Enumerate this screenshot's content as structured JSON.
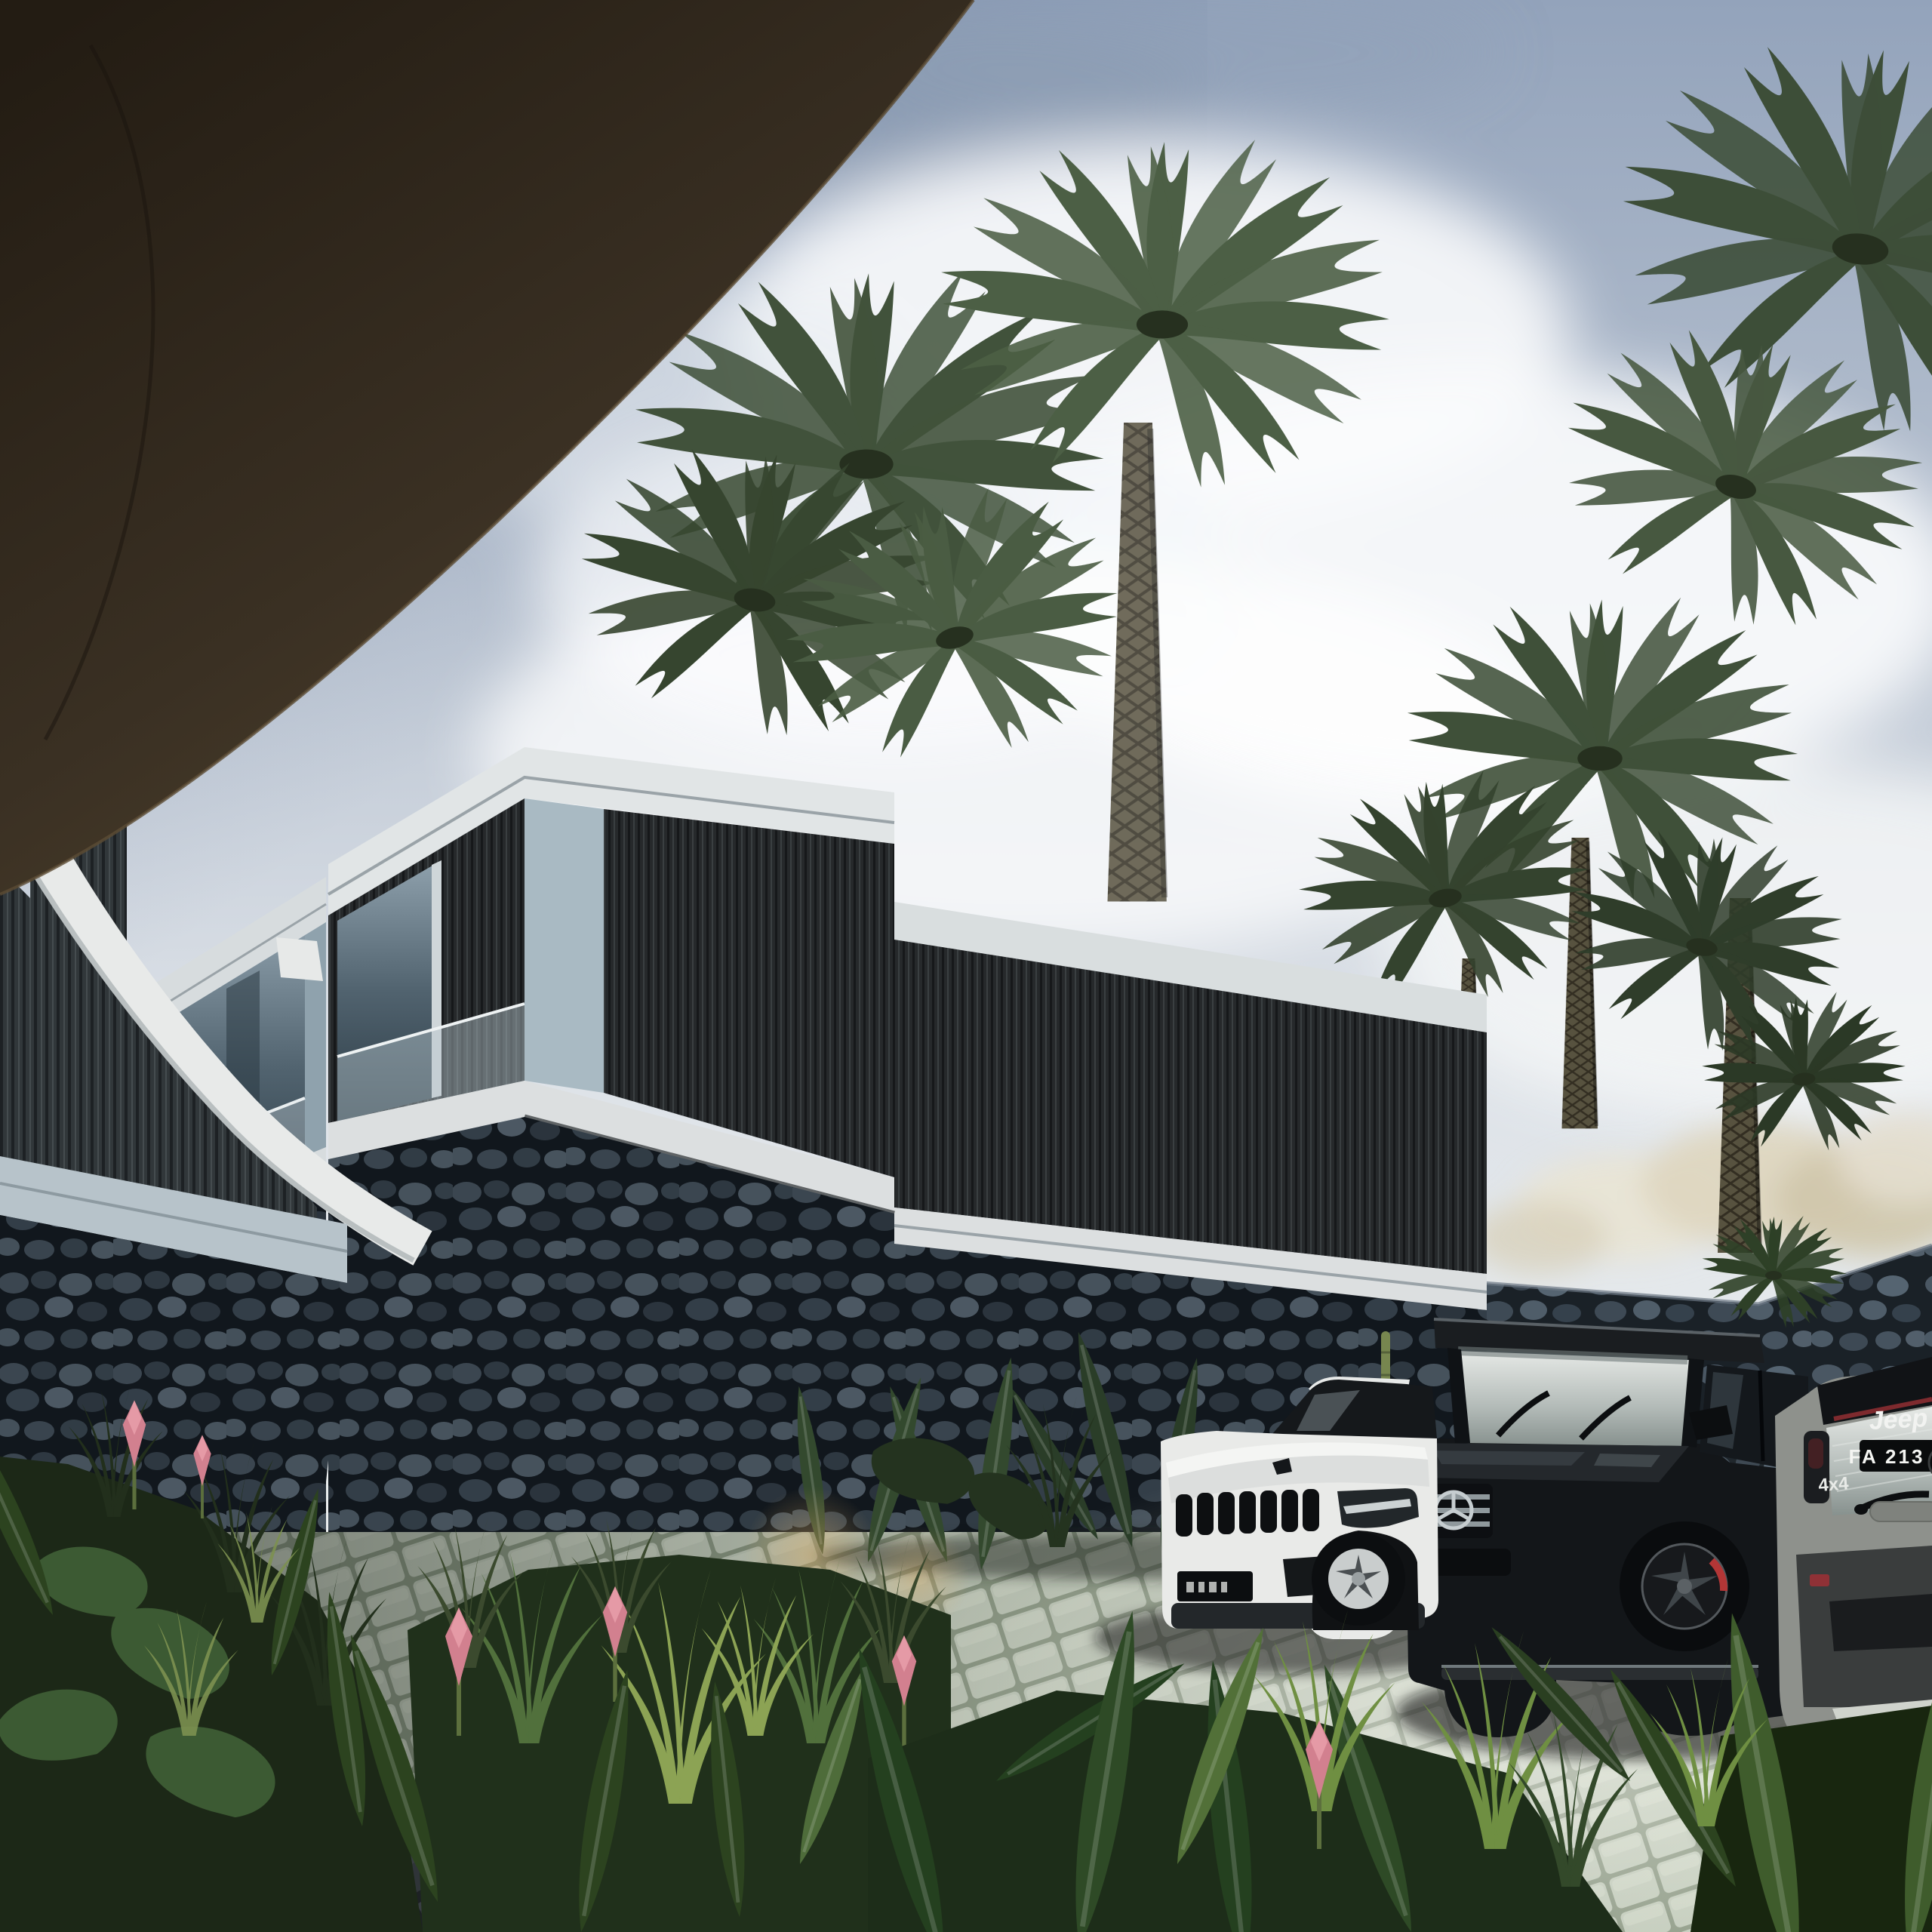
{
  "scene": {
    "title": "Tropical modern villa complex — exterior architectural render",
    "time_of_day": "daytime, soft overcast sky",
    "elements": [
      "dark curved concrete canopy overhead (top-left)",
      "row of stacked modern villas with light concrete frames",
      "dark vertical timber-slat facades",
      "natural lava-stone plinth walls",
      "glass balustrades and sliding glass doors",
      "tall date palms and tropical planting",
      "cobblestone parking court",
      "dark paver driveway (foreground left)",
      "three parked SUVs"
    ]
  },
  "palette": {
    "sky_top": "#93a3bb",
    "sky_light": "#eef0f1",
    "canopy_brown": "#2b2219",
    "fascia_white": "#dfe3e4",
    "pier_gray": "#9db0ba",
    "slat_charcoal": "#26292b",
    "glass_blue": "#51636f",
    "stone_dark": "#222a31",
    "road_dark": "#3a3f45",
    "cobble_light": "#c7d0bf",
    "foliage_dark": "#24341f",
    "foliage_light": "#8ca354",
    "flower_pink": "#d2808f"
  },
  "vehicles": {
    "white_suv": {
      "brand": "Jeep",
      "color": "white",
      "view": "front three-quarter",
      "features": [
        "seven-slot grille",
        "silver alloy wheel",
        "dark license plate"
      ]
    },
    "black_suv": {
      "brand": "Mercedes-Benz G-Class",
      "color": "black",
      "view": "front-side",
      "emblem": "three-pointed star",
      "features": [
        "chrome grille bars",
        "red brake caliper",
        "black alloy wheels"
      ]
    },
    "gray_suv": {
      "brand": "Jeep",
      "color": "warm gray",
      "view": "rear",
      "badge_brand": "Jeep",
      "badge_drivetrain": "4x4",
      "license_plate": "FA 213 D"
    }
  },
  "vegetation": {
    "palms": "date palms with diamond-cut trunks behind stone boundary wall",
    "foreground": "ginger flowers, grasses, monstera and banana leaves",
    "flowers": "pink torch ginger"
  }
}
